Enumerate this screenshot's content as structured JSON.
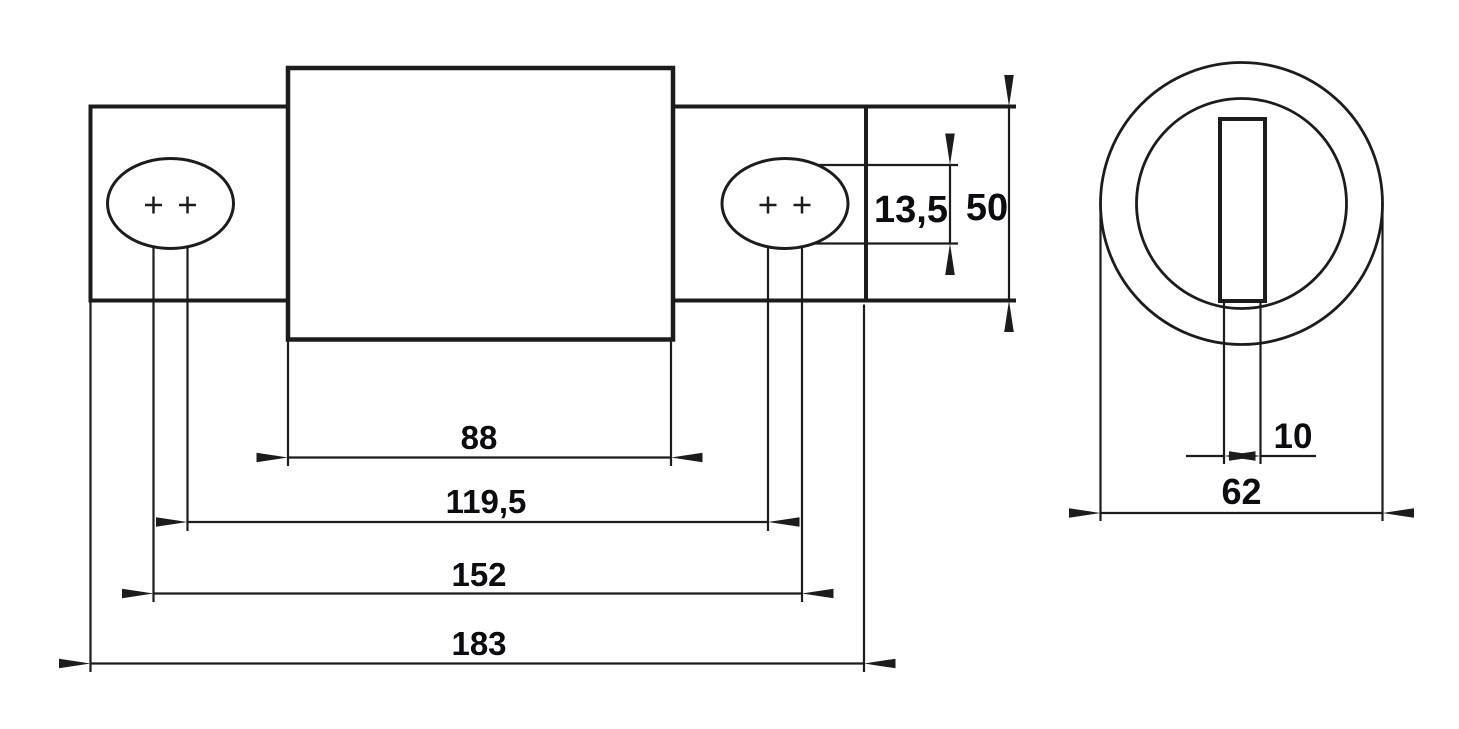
{
  "drawing_type": "technical-dimension-drawing",
  "colors": {
    "background": "#ffffff",
    "line": "#1c1c1c",
    "text": "#0c0c10"
  },
  "front_view": {
    "body_width_label": "88",
    "hole_spacing_inner_label": "119,5",
    "hole_spacing_outer_label": "152",
    "overall_length_label": "183",
    "slot_height_label": "13,5",
    "tab_height_label": "50"
  },
  "side_view": {
    "slot_width_label": "10",
    "outer_diameter_label": "62"
  }
}
